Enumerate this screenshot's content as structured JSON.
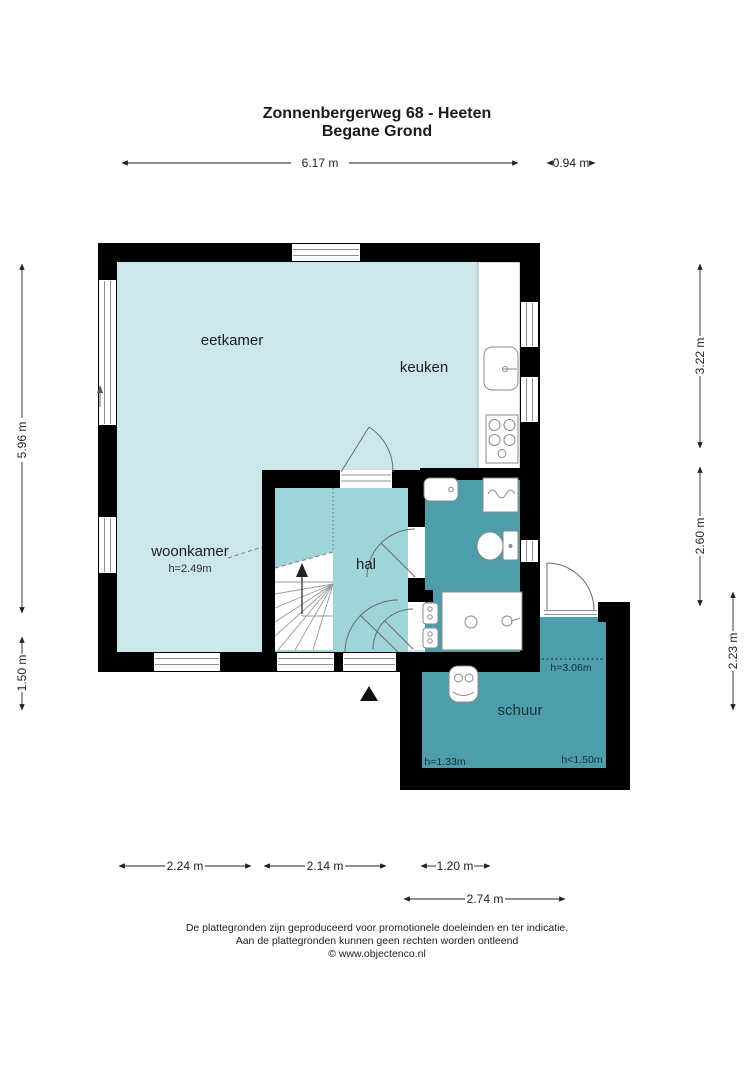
{
  "title": {
    "line1": "Zonnenbergerweg 68 - Heeten",
    "line2": "Begane Grond"
  },
  "rooms": {
    "eetkamer": {
      "label": "eetkamer"
    },
    "keuken": {
      "label": "keuken"
    },
    "woonkamer": {
      "label": "woonkamer",
      "ceiling_height": "h=2.49m"
    },
    "hal": {
      "label": "hal"
    },
    "schuur": {
      "label": "schuur",
      "ceiling_height_back": "h=3.06m",
      "ceiling_height_left": "h=1.33m",
      "ceiling_height_right": "h<1.50m"
    }
  },
  "dimensions": {
    "top_width_main": "6.17 m",
    "top_width_extension": "0.94 m",
    "left_height_main": "5.96 m",
    "left_height_extension": "1.50 m",
    "right_height_top": "3.22 m",
    "right_height_middle": "2.60 m",
    "right_height_extension": "2.23 m",
    "bottom_width_woonkamer": "2.24 m",
    "bottom_width_hal": "2.14 m",
    "bottom_width_passage": "1.20 m",
    "bottom_width_schuur": "2.74 m"
  },
  "footer": {
    "line1": "De plattegronden zijn geproduceerd voor promotionele doeleinden en ter indicatie.",
    "line2": "Aan de plattegronden kunnen geen rechten worden ontleend",
    "line3": "© www.objectenco.nl"
  },
  "colors": {
    "room_light": "#cbe7ea",
    "room_medium": "#9fd4d9",
    "room_dark": "#4e9dab",
    "wall": "#000000"
  }
}
